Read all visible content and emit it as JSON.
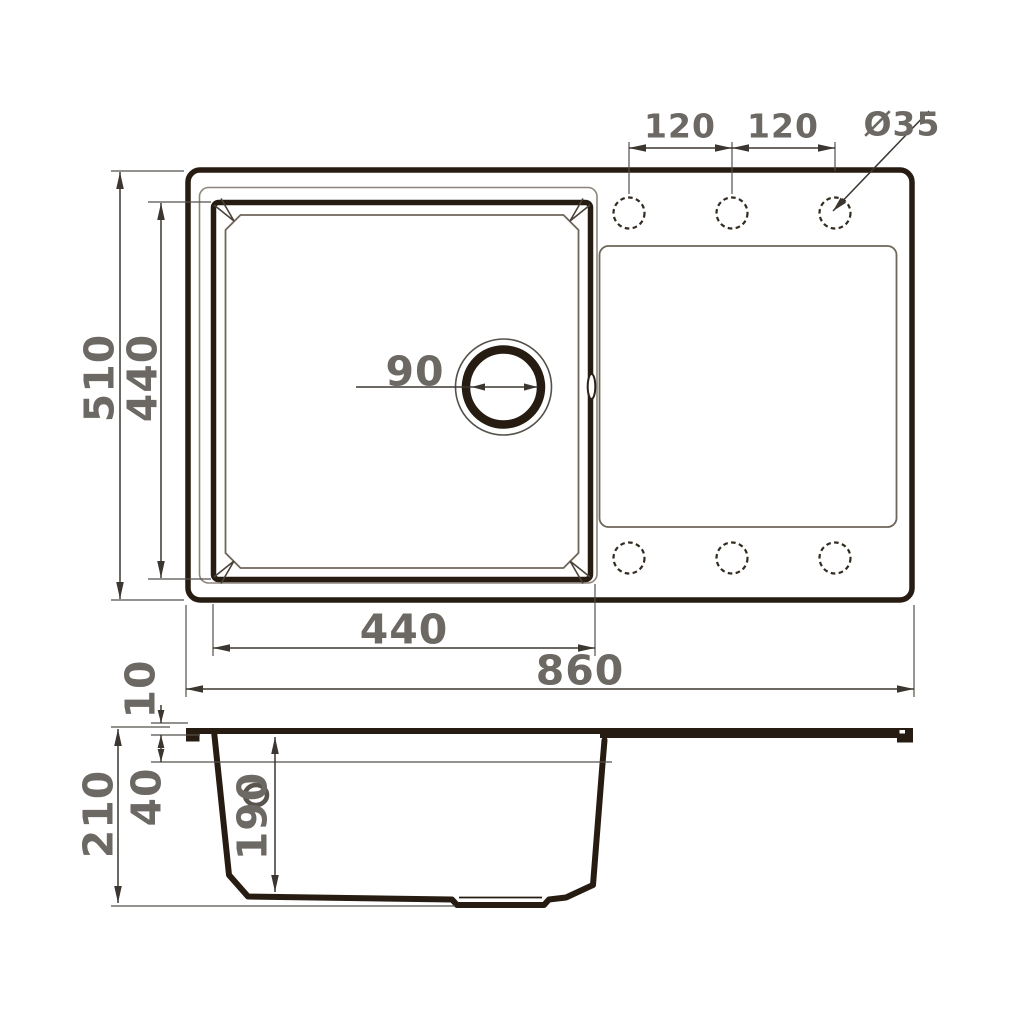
{
  "drawing": {
    "subject": "kitchen sink with drainboard - dimensional drawing, top view and cross-section",
    "units": "mm",
    "colors": {
      "outline_dark": "#261c11",
      "thin_line": "#8d857b",
      "mid_line": "#6e6659",
      "dimension_line": "#3c3631",
      "dimension_text": "#6c6863",
      "background": "#ffffff"
    },
    "top_view": {
      "dims": {
        "overall_width": "860",
        "overall_depth": "510",
        "bowl_width": "440",
        "bowl_depth": "440",
        "drain_diameter": "90",
        "hole_spacing_left": "120",
        "hole_spacing_right": "120",
        "hole_diameter": "Ø35"
      },
      "faucet_hole_count": 6
    },
    "side_view": {
      "dims": {
        "total_height": "210",
        "edge_height": "10",
        "apron_height": "40",
        "bowl_inner_depth": "190"
      }
    }
  }
}
